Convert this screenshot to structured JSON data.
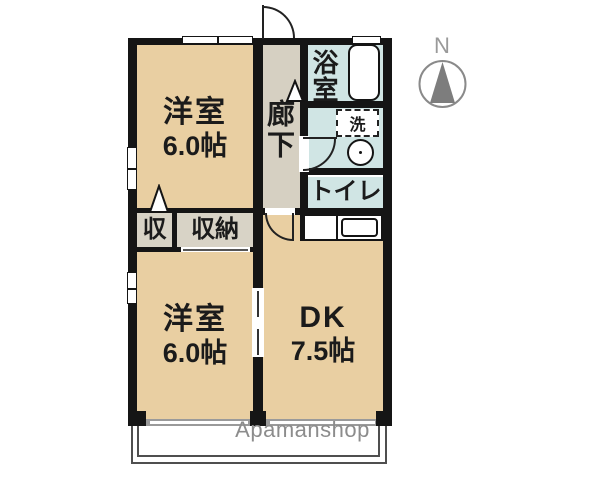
{
  "floorplan": {
    "watermark": "Apamanshop",
    "compass": {
      "label": "N"
    },
    "rooms": {
      "bedroom_top": {
        "name": "洋室",
        "size": "6.0帖"
      },
      "bedroom_bottom": {
        "name": "洋室",
        "size": "6.0帖"
      },
      "dk": {
        "name": "DK",
        "size": "7.5帖"
      },
      "hallway": {
        "name": "廊下"
      },
      "bathroom": {
        "name": "浴室"
      },
      "washroom": {
        "laundry": "洗"
      },
      "toilet": {
        "name": "トイレ"
      },
      "closet_small": {
        "name": "収"
      },
      "closet_large": {
        "name": "収納"
      }
    },
    "colors": {
      "wall": "#151515",
      "room": "#e9cfa2",
      "hallway": "#d6d0c2",
      "wet_area": "#d0e5e4",
      "closet": "#d8d3c6",
      "balcony_line": "#4f4f4f",
      "watermark": "#8c8c8c",
      "compass": "#8a8a8a"
    }
  }
}
